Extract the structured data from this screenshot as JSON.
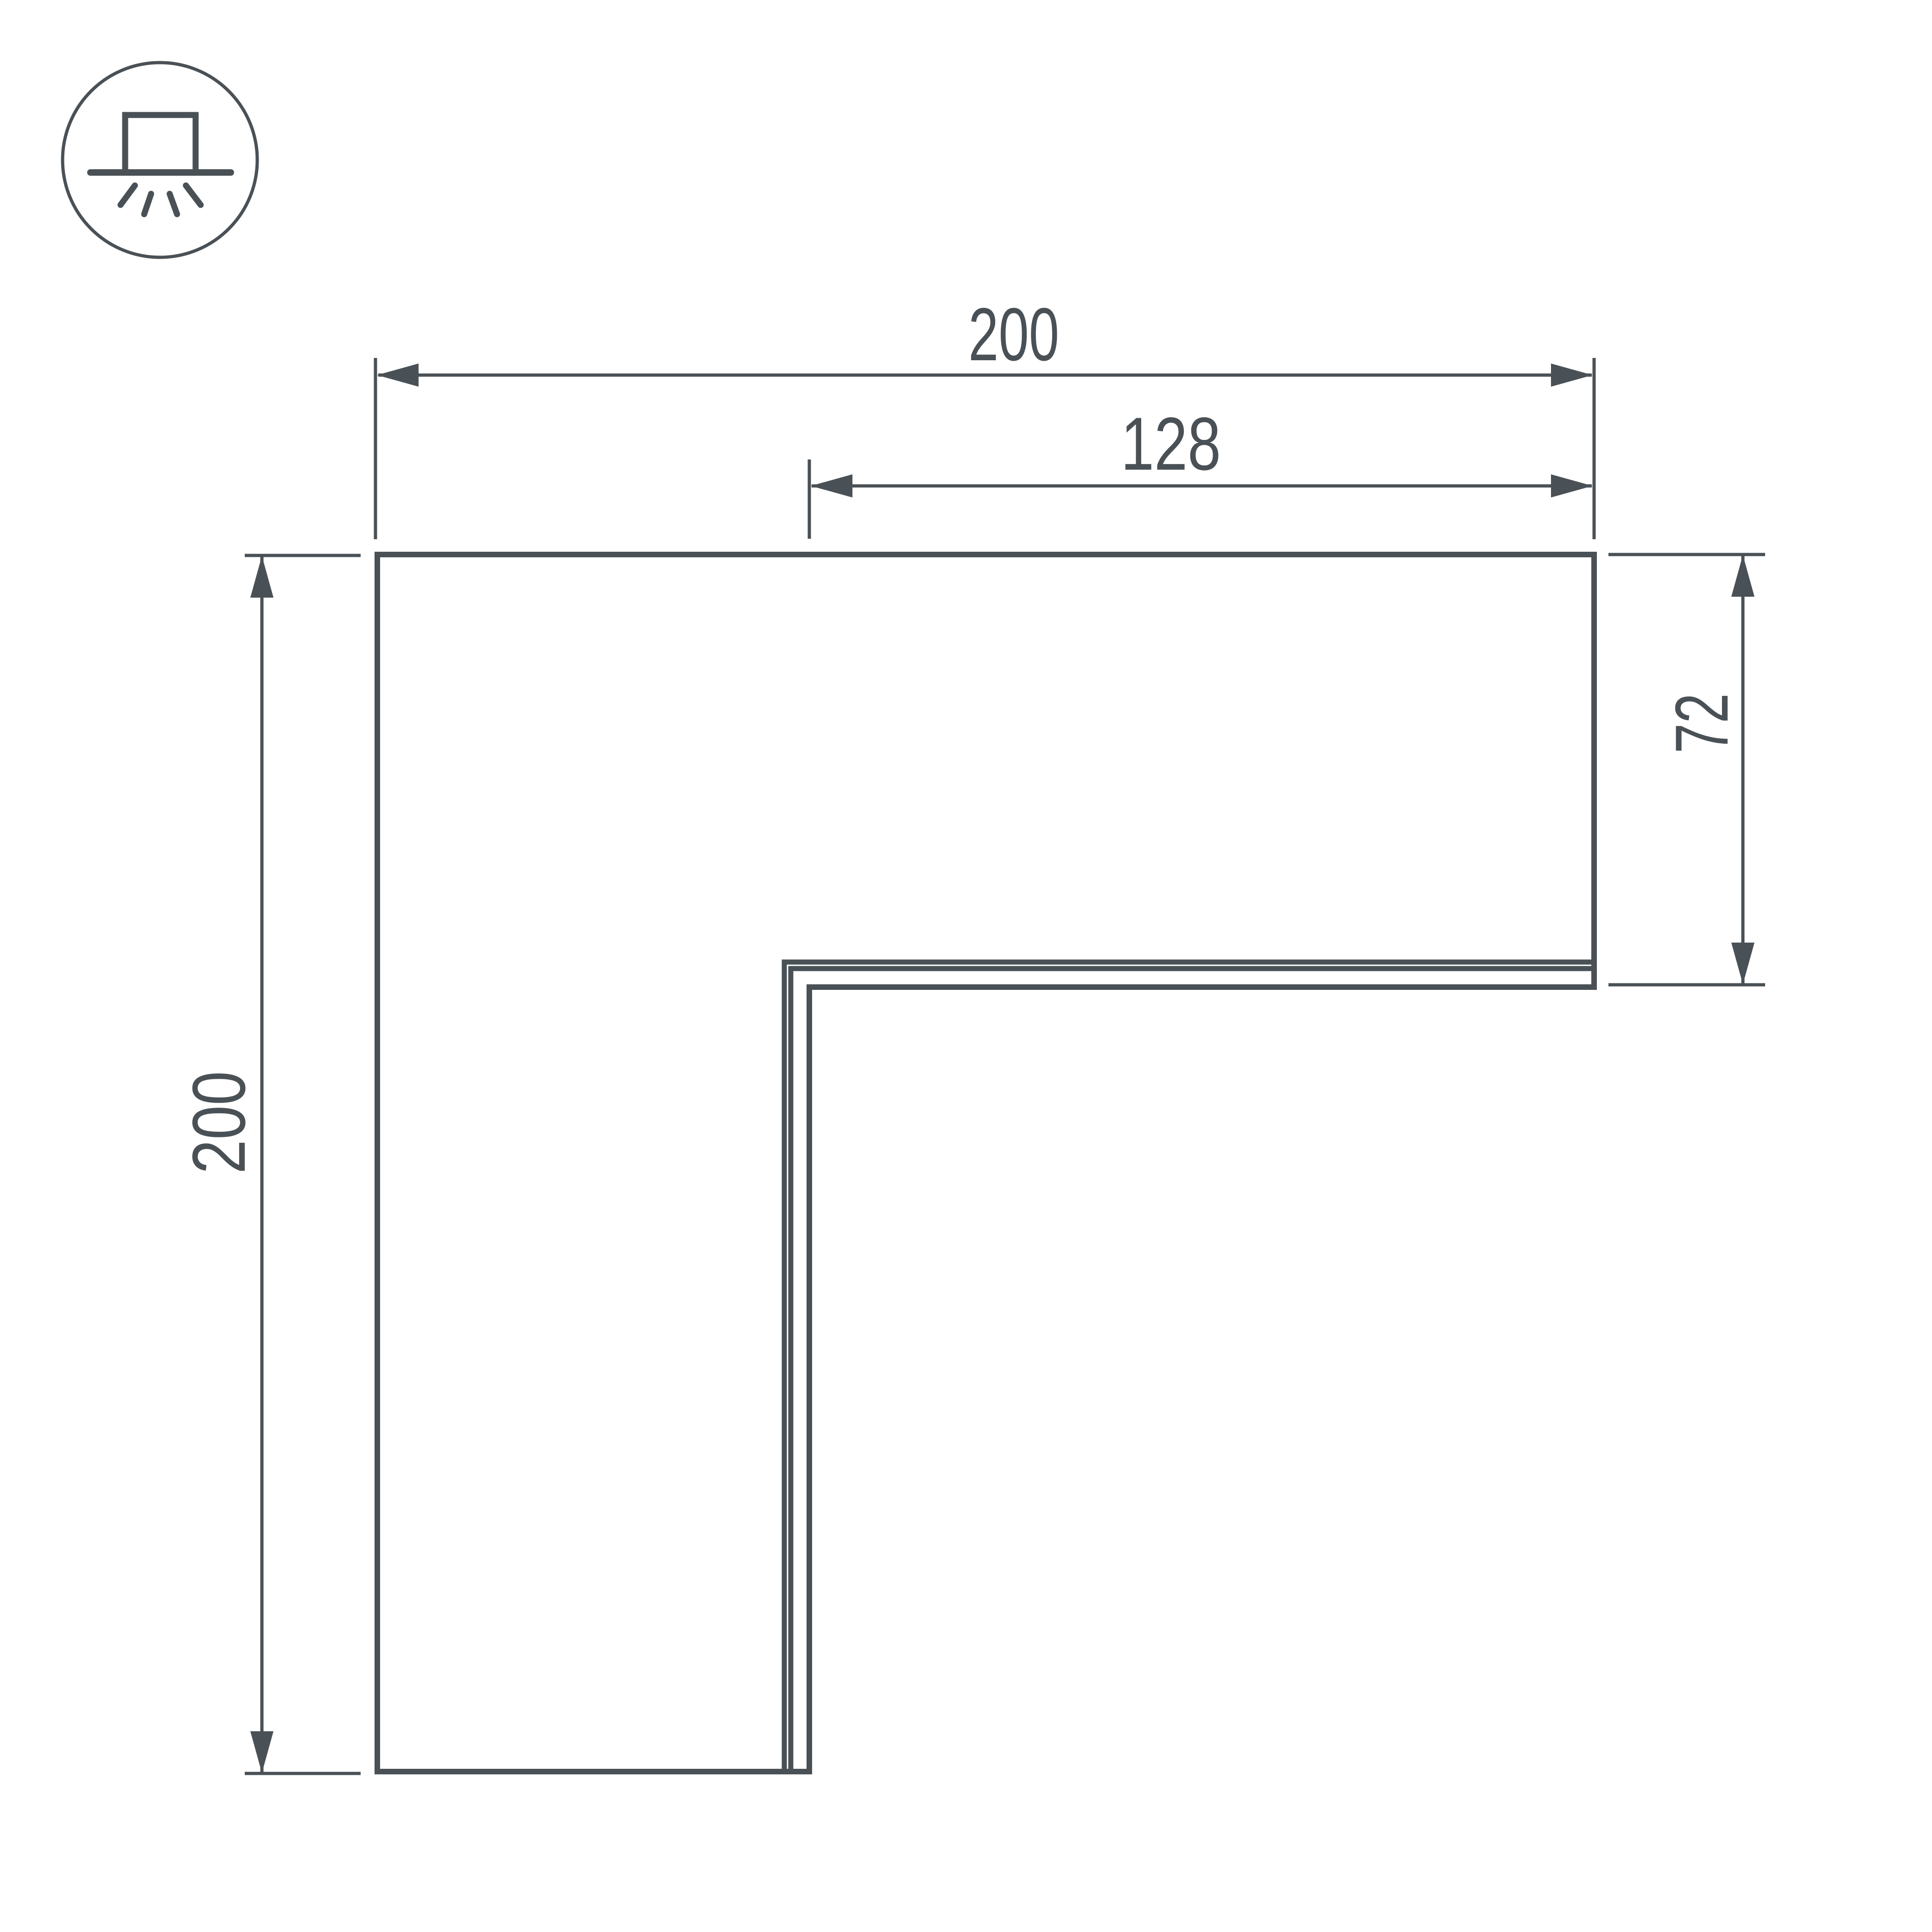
{
  "drawing": {
    "type": "technical-dimension-drawing",
    "part": "L-shaped corner profile, top view",
    "icon": "surface-mounted-light-icon",
    "dimensions": {
      "top_width": "200",
      "inner_width": "128",
      "arm_height": "72",
      "left_height": "200"
    },
    "colors": {
      "line": "#4a5156",
      "background": "#ffffff"
    }
  }
}
